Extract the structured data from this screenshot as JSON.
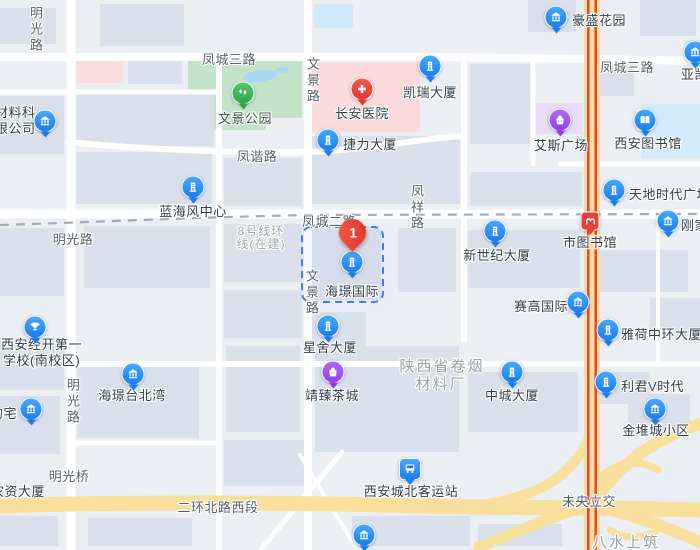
{
  "pin": {
    "number": "1",
    "attached_poi": "海璟国际"
  },
  "pois": [
    {
      "name": "豪盛花园",
      "icon": "bank-icon"
    },
    {
      "name": "亚凯",
      "icon": "bank-icon"
    },
    {
      "name": "凯瑞大厦",
      "icon": "building-icon"
    },
    {
      "name": "长安医院",
      "icon": "hospital-cross-icon"
    },
    {
      "name": "捷力大厦",
      "icon": "building-icon"
    },
    {
      "name": "艾斯广场",
      "icon": "shopping-bag-icon"
    },
    {
      "name": "西安图书馆",
      "icon": "book-icon"
    },
    {
      "name": "天地时代广场",
      "icon": "building-icon"
    },
    {
      "name": "刚家",
      "icon": "bank-icon"
    },
    {
      "name": "蓝海风中心",
      "icon": "building-icon"
    },
    {
      "name": "市图书馆",
      "icon": "metro-icon"
    },
    {
      "name": "新世纪大厦",
      "icon": "building-icon"
    },
    {
      "name": "海璟国际",
      "icon": "building-icon"
    },
    {
      "name": "赛高国际",
      "icon": "bank-icon"
    },
    {
      "name": "雅荷中环大厦",
      "icon": "building-icon"
    },
    {
      "name": "星舍大厦",
      "icon": "building-icon"
    },
    {
      "name": "靖臻茶城",
      "icon": "shopping-bag-icon"
    },
    {
      "name": "海璟台北湾",
      "icon": "bank-icon"
    },
    {
      "line1": "西安经开第一",
      "line2": "学校(南校区)",
      "icon": "trophy-icon"
    },
    {
      "name": "约宅",
      "icon": "bank-icon"
    },
    {
      "line1": "材料科",
      "line2": "限公司",
      "icon": "bank-icon"
    },
    {
      "name": "中城大厦",
      "icon": "building-icon"
    },
    {
      "name": "利君V时代",
      "icon": "building-icon"
    },
    {
      "name": "金堆城小区",
      "icon": "bank-icon"
    },
    {
      "name": "西安城北客运站",
      "icon": "bus-icon"
    },
    {
      "name": "",
      "icon": "bank-icon"
    },
    {
      "name": "农资大厦",
      "icon": "none"
    }
  ],
  "roads": [
    {
      "text": "明光路",
      "orientation": "vertical"
    },
    {
      "text": "凤城三路",
      "orientation": "horizontal"
    },
    {
      "text": "文景路",
      "orientation": "vertical"
    },
    {
      "text": "凤谐路",
      "orientation": "horizontal"
    },
    {
      "text": "明光路",
      "orientation": "horizontal"
    },
    {
      "text": "凤城二路",
      "orientation": "horizontal"
    },
    {
      "text": "凤祥路",
      "orientation": "vertical"
    },
    {
      "text": "凤城三路",
      "orientation": "horizontal"
    },
    {
      "text": "文景路",
      "orientation": "vertical"
    },
    {
      "text": "明光桥",
      "orientation": "horizontal"
    },
    {
      "text": "二环北路西段",
      "orientation": "horizontal"
    },
    {
      "text": "未央立交",
      "orientation": "horizontal"
    },
    {
      "text": "明光路",
      "orientation": "vertical"
    }
  ],
  "areas": [
    {
      "line1": "陕西省卷烟",
      "line2": "材料厂"
    },
    {
      "name": "八水上筑"
    },
    {
      "name": "文景公园",
      "icon": "park-trees-icon"
    }
  ],
  "transit": {
    "metro_note_line1": "8号线环",
    "metro_note_line2": "线(在建)"
  },
  "colors": {
    "marker_blue": "#1b7df0",
    "marker_purple": "#8e3fe8",
    "pin_red": "#e2382f",
    "hospital_red": "#f0483e",
    "park_green": "#2da84c",
    "park_fill": "#c3e3c8",
    "hospital_fill": "#fadada",
    "plaza_purple_fill": "#e8dcf7",
    "water_fill": "#a9d6f2",
    "road_yellow": "#f8df9c",
    "expressway_red": "#e64a40",
    "boundary_blue": "#4a7ce0",
    "metro_dash_gray": "#a6acb4"
  }
}
